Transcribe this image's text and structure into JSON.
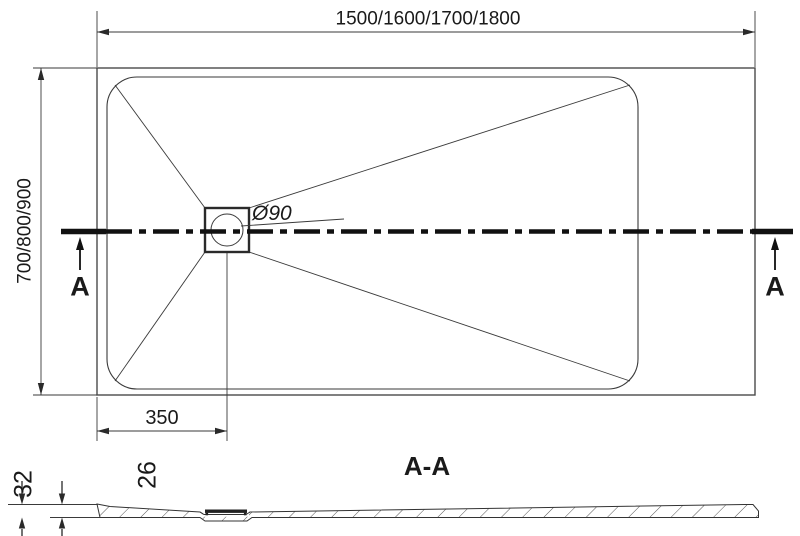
{
  "top_view": {
    "width_label": "1500/1600/1700/1800",
    "height_label": "700/800/900",
    "drain_label": "Ø90",
    "drain_offset_label": "350",
    "section_left_label": "A",
    "section_right_label": "A"
  },
  "section_view": {
    "title": "A-A",
    "edge_height_label": "32",
    "inner_height_label": "26"
  },
  "colors": {
    "line": "#333333",
    "heavy_line": "#111111",
    "background": "#ffffff"
  }
}
